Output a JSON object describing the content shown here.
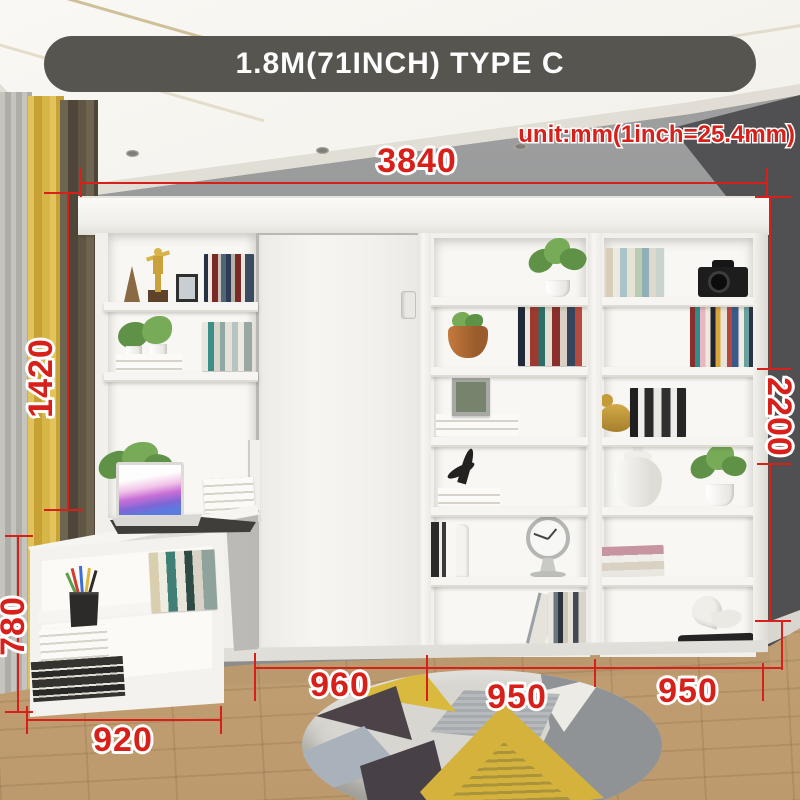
{
  "banner": {
    "label": "1.8M(71INCH) TYPE C"
  },
  "unit_note": {
    "text": "unit:mm(1inch=25.4mm)"
  },
  "dimensions": {
    "overall_width": "3840",
    "left_tower_height": "1420",
    "total_height": "2200",
    "desk_unit_height": "780",
    "desk_unit_width": "920",
    "bed_cabinet_width": "960",
    "right_shelf_width_1": "950",
    "right_shelf_width_2": "950"
  },
  "colors": {
    "dimension_red": "#d8201a",
    "banner_bg": "#57554f",
    "banner_text": "#fdfdfd",
    "wall_gray": "#98999a",
    "wall_dark_right": "#5a5a5c",
    "floor_wood": "#c9a77b",
    "curtain_yellow": "#d8b74a",
    "furniture_white": "#f4f3f0",
    "rug_yellow": "#d4b23c",
    "rug_gray": "#909396",
    "rug_charcoal": "#4b4347"
  }
}
